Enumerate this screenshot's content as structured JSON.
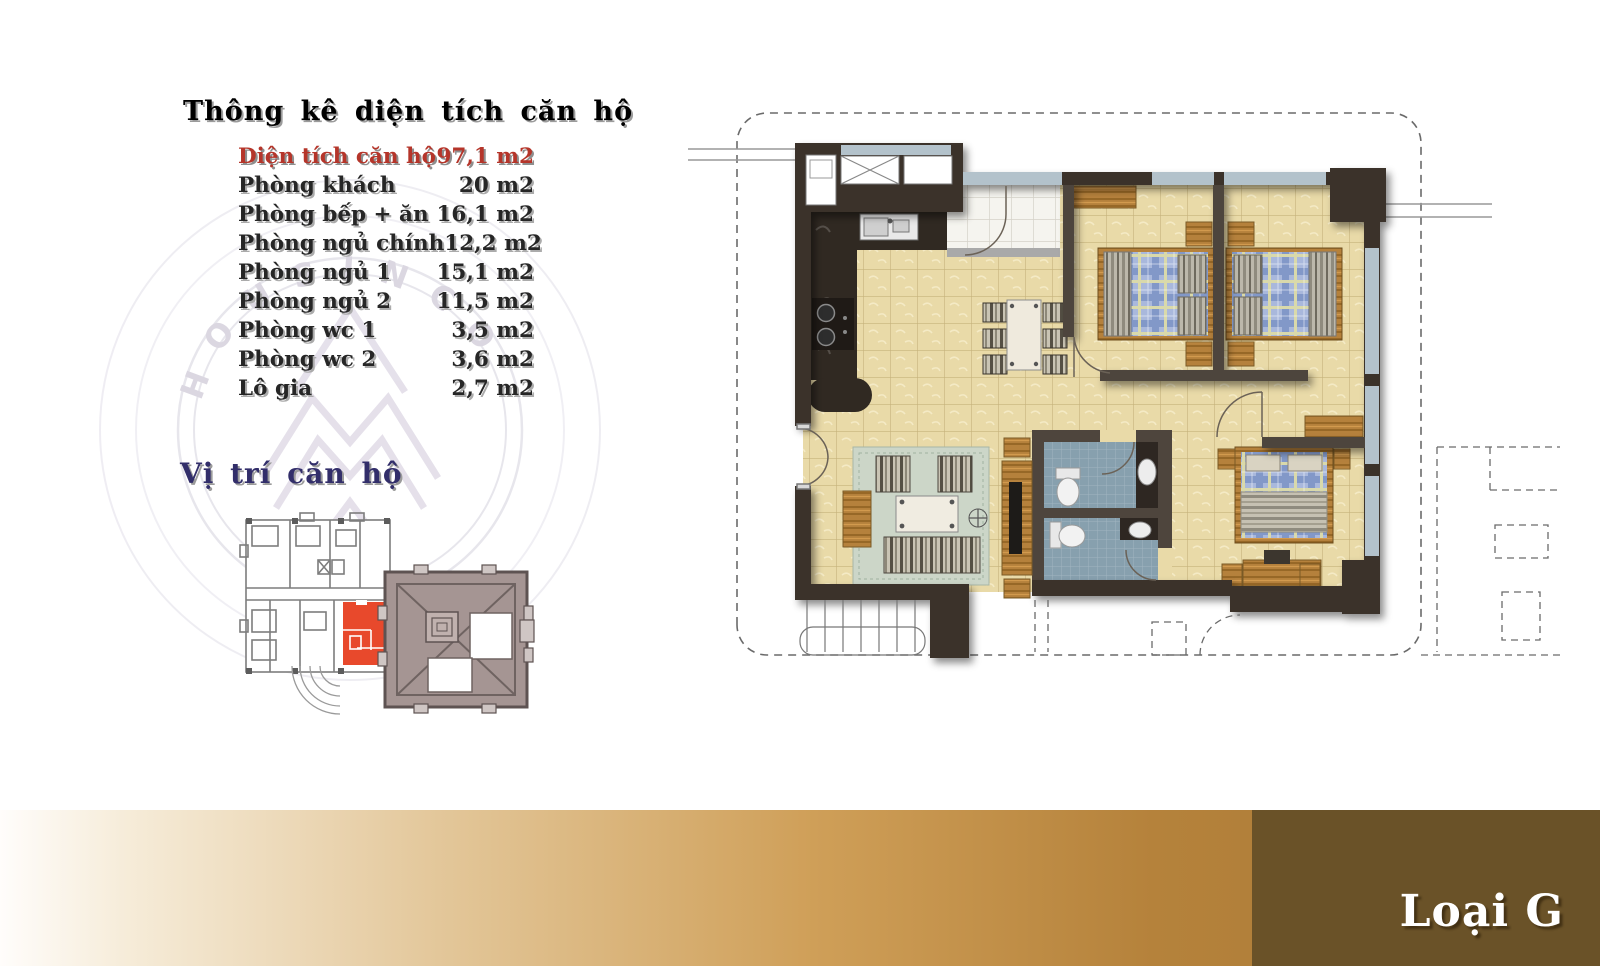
{
  "stats_panel": {
    "title": "Thông kê diện tích căn hộ",
    "rows": [
      {
        "label": "Diện tích căn hộ",
        "value": "97,1 m2",
        "highlight": true
      },
      {
        "label": "Phòng khách",
        "value": "20 m2",
        "highlight": false
      },
      {
        "label": "Phòng bếp + ăn",
        "value": "16,1 m2",
        "highlight": false
      },
      {
        "label": "Phòng ngủ chính",
        "value": "12,2 m2",
        "highlight": false
      },
      {
        "label": "Phòng ngủ 1",
        "value": "15,1 m2",
        "highlight": false
      },
      {
        "label": "Phòng ngủ 2",
        "value": "11,5 m2",
        "highlight": false
      },
      {
        "label": "Phòng wc 1",
        "value": "3,5 m2",
        "highlight": false
      },
      {
        "label": "Phòng wc 2",
        "value": "3,6 m2",
        "highlight": false
      },
      {
        "label": "Lô gia",
        "value": "2,7 m2",
        "highlight": false
      }
    ]
  },
  "location_panel": {
    "title": "Vị trí căn hộ",
    "highlight_unit_color": "#e8492c",
    "tower_color": "#a59593"
  },
  "watermark": {
    "text": "HOUSINCO"
  },
  "footer": {
    "type_label": "Loại G",
    "gradient_colors": [
      "#ffffff",
      "#e3c79a",
      "#b5823b"
    ],
    "dark_color": "#6a5228"
  },
  "floor_plan": {
    "wall_color": "#3b332c",
    "floor_tile_color": "#e9daa8",
    "bathroom_tile_color": "#87a0ae",
    "window_color": "#b3c2cb",
    "wood_color": "#b5813c",
    "bed_plaid_color": "#a9b8dc",
    "rug_color": "#ccd6c8"
  }
}
